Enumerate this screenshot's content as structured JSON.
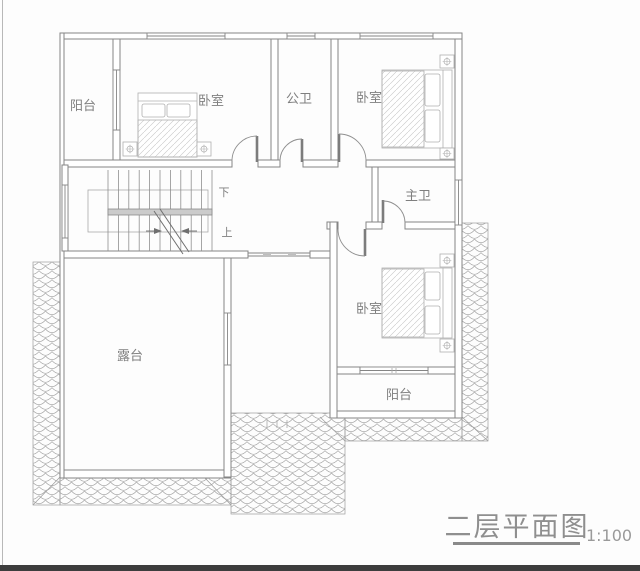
{
  "plan": {
    "rooms": [
      {
        "id": "balcony-left",
        "label": "阳台"
      },
      {
        "id": "bedroom-top-left",
        "label": "卧室"
      },
      {
        "id": "public-bath",
        "label": "公卫"
      },
      {
        "id": "bedroom-top-right",
        "label": "卧室"
      },
      {
        "id": "master-bath",
        "label": "主卫"
      },
      {
        "id": "bedroom-bottom-right",
        "label": "卧室"
      },
      {
        "id": "balcony-bottom",
        "label": "阳台"
      },
      {
        "id": "terrace",
        "label": "露台"
      }
    ],
    "stairs": {
      "down_label": "下",
      "up_label": "上"
    },
    "title": {
      "text": "二层平面图",
      "scale": "1:100"
    },
    "colors": {
      "line": "#858585",
      "text": "#7f7f7f",
      "tile": "#a6a6a6",
      "handrail": "#cbcbcb",
      "title_text": "#8f8f8f",
      "underline": "#8a8a8a",
      "bottom_bar": "#3d3d3d"
    }
  }
}
